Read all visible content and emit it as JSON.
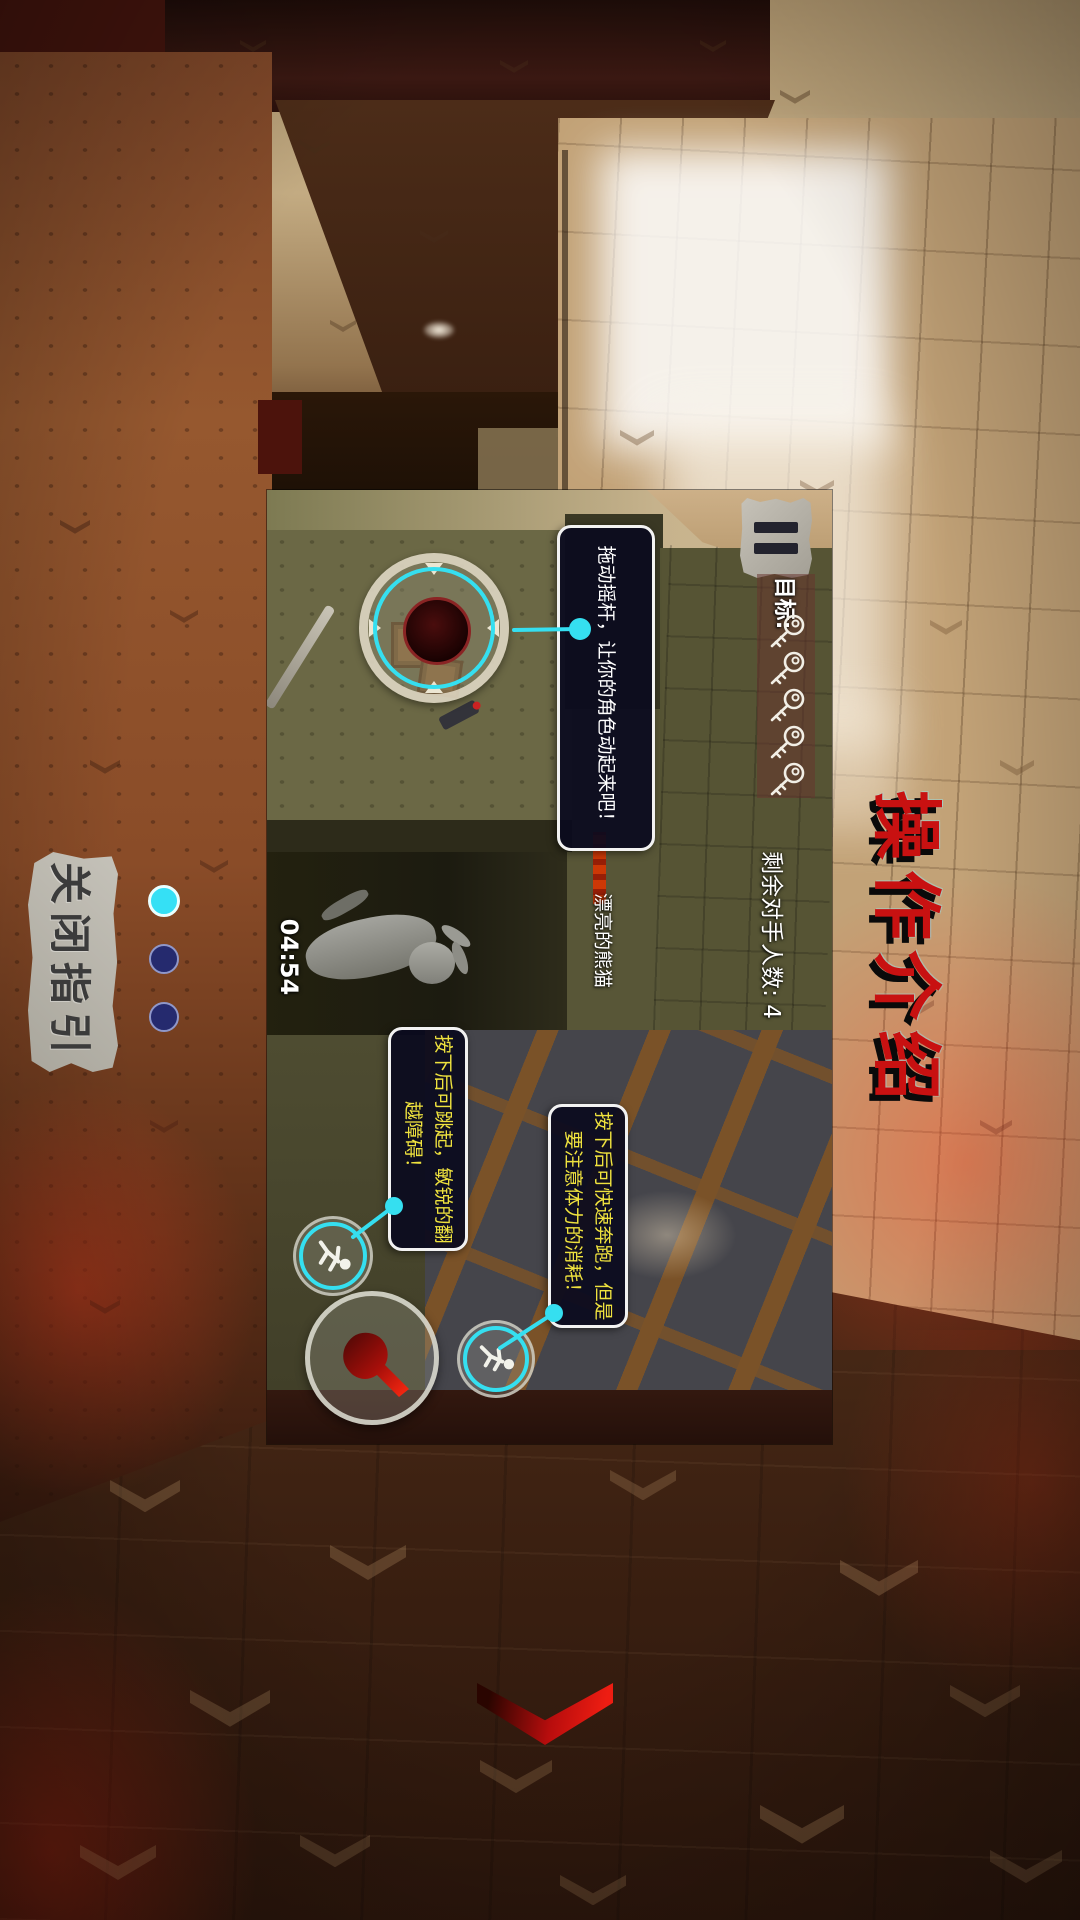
{
  "title": "操作介绍",
  "guide": {
    "close_label": "关闭指引",
    "pagination": [
      {
        "state": "active"
      },
      {
        "state": "inactive"
      },
      {
        "state": "inactive"
      }
    ]
  },
  "panel": {
    "goal": {
      "label": "目标:",
      "keys_count": 5
    },
    "opponents_text": "剩余对手人数: 4",
    "timer": "04:54",
    "player_label": "漂亮的熊猫",
    "tooltips": {
      "joystick": {
        "text": "拖动摇杆，让你的角色动起来吧！"
      },
      "jump": {
        "line1": "按下后可跳起，敏锐的翻",
        "line2": "越障碍！"
      },
      "sprint": {
        "line1": "按下后可快速奔跑，但是",
        "line2": "要注意体力的消耗！"
      }
    }
  },
  "colors": {
    "connector_cyan": "#35dff0",
    "tooltip_yellow": "#efe23e",
    "title_red": "#c81111",
    "chevron_red": "#ee1d12"
  }
}
